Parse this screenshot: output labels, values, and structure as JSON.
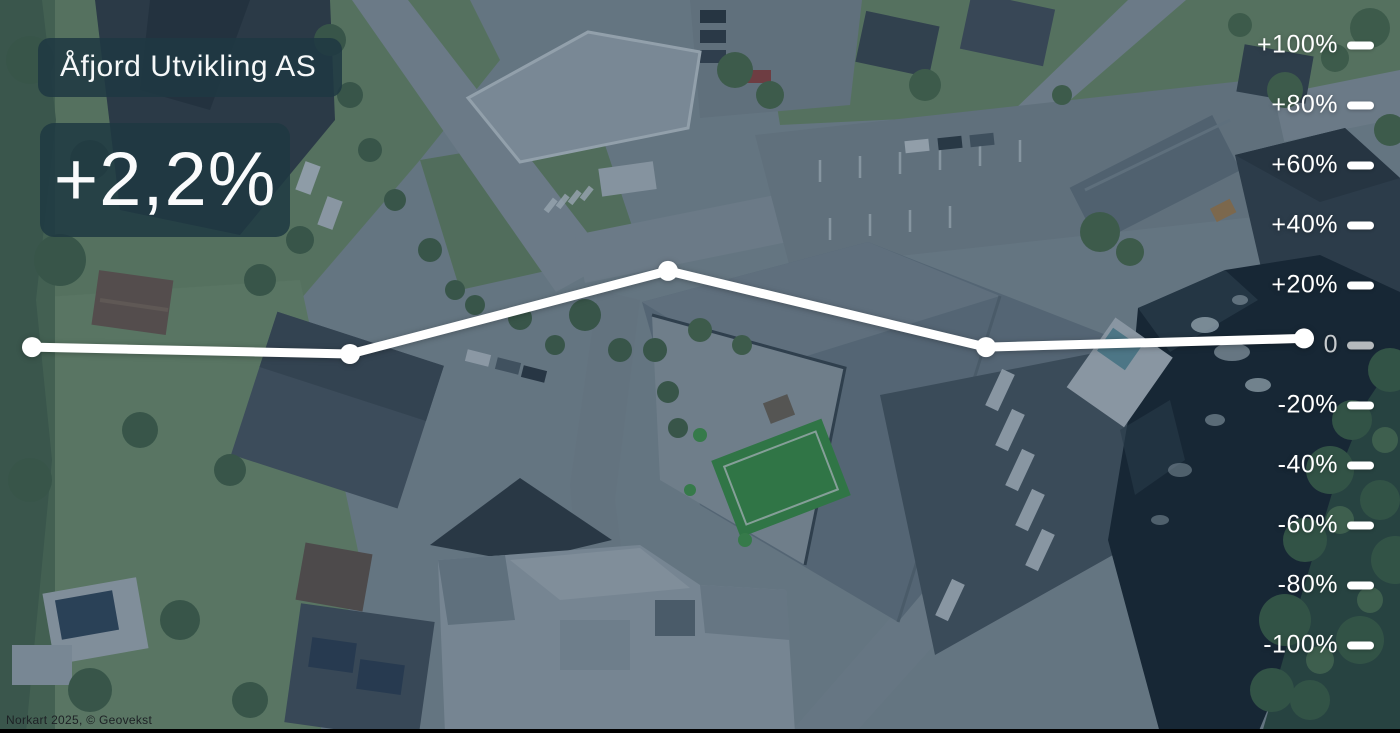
{
  "header": {
    "company": "Åfjord Utvikling AS",
    "change_display": "+2,2%"
  },
  "map": {
    "attribution": "Norkart 2025, © Geovekst"
  },
  "chart_data": {
    "type": "line",
    "title": "Åfjord Utvikling AS",
    "headline_value": "+2,2%",
    "unit": "%",
    "series": [
      {
        "name": "Åfjord Utvikling AS",
        "values": [
          -0.7,
          -3,
          24.7,
          -0.7,
          2.2
        ]
      }
    ],
    "ylim": [
      -100,
      100
    ],
    "grid": false,
    "legend": false,
    "axis_position": "right",
    "line_color": "#ffffff",
    "point_color": "#ffffff",
    "axis_color": "#ffffff",
    "zero_axis_color": "#b4b9bc",
    "y_axis": {
      "ticks": [
        {
          "label": "+100%",
          "value": 100
        },
        {
          "label": "+80%",
          "value": 80
        },
        {
          "label": "+60%",
          "value": 60
        },
        {
          "label": "+40%",
          "value": 40
        },
        {
          "label": "+20%",
          "value": 20
        },
        {
          "label": "0",
          "value": 0
        },
        {
          "label": "-20%",
          "value": -20
        },
        {
          "label": "-40%",
          "value": -40
        },
        {
          "label": "-60%",
          "value": -60
        },
        {
          "label": "-80%",
          "value": -80
        },
        {
          "label": "-100%",
          "value": -100
        }
      ]
    }
  },
  "colors": {
    "card_bg": "rgba(30,56,66,0.86)",
    "overlay_tint": "#1f3a50",
    "line": "#ffffff"
  }
}
